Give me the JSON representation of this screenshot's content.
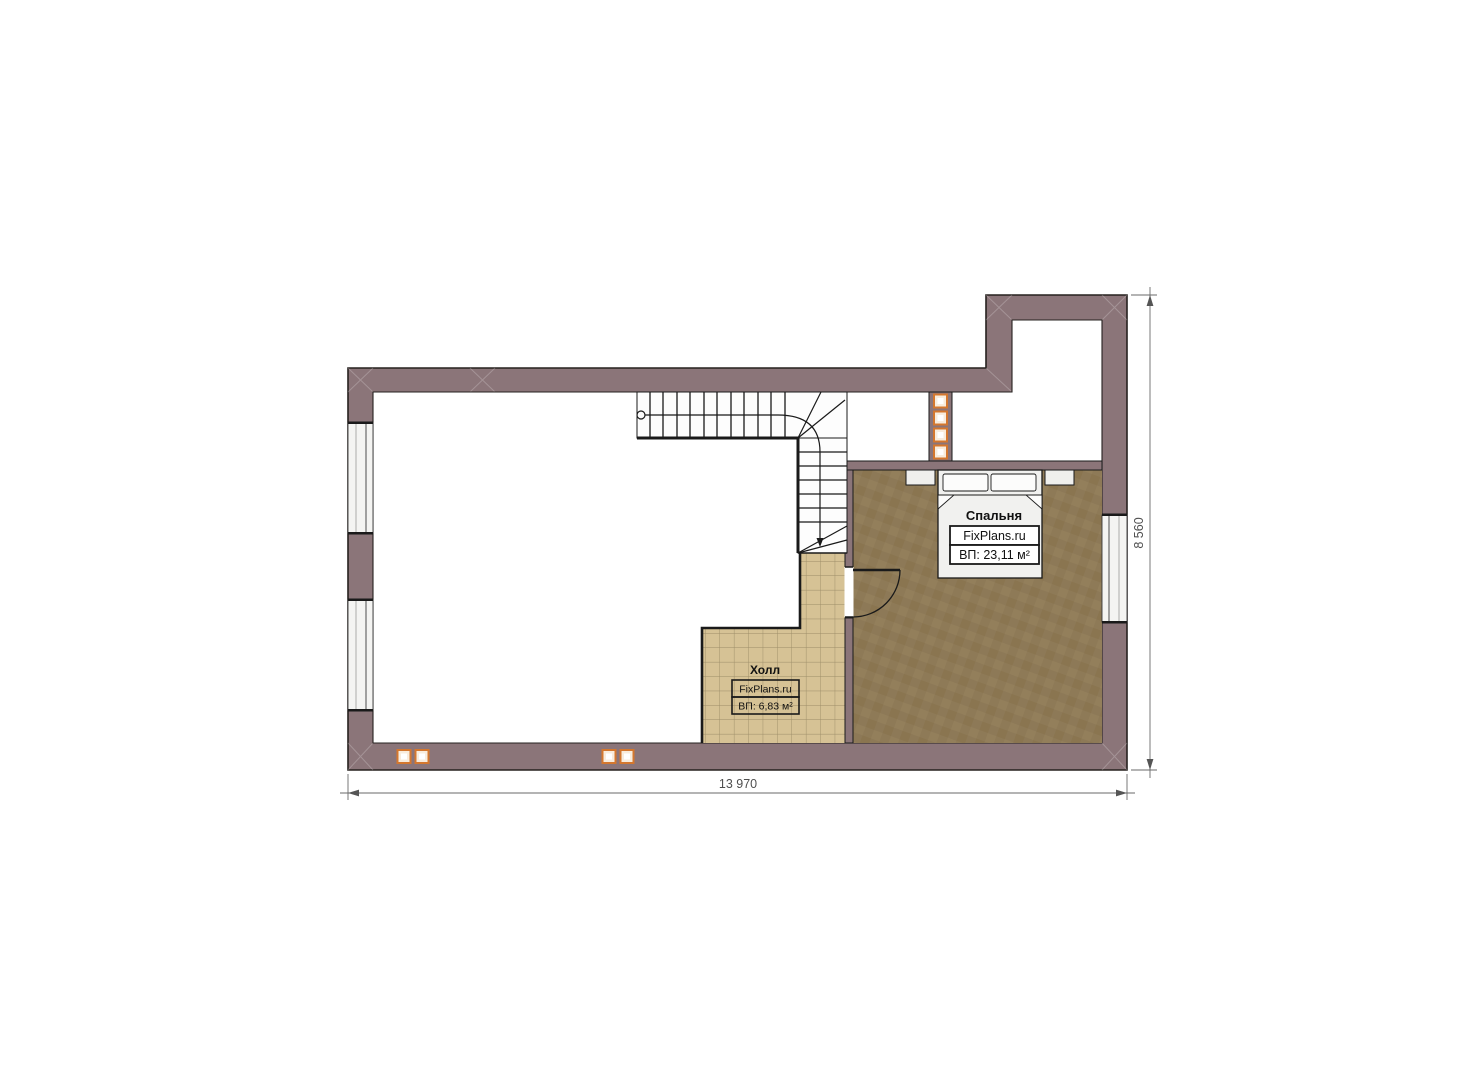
{
  "plan": {
    "rooms": {
      "bedroom": {
        "name": "Спальня",
        "site": "FixPlans.ru",
        "area": "ВП: 23,11 м²"
      },
      "hall": {
        "name": "Холл",
        "site": "FixPlans.ru",
        "area": "ВП: 6,83 м²"
      }
    },
    "dimensions": {
      "bottom": "13 970",
      "right": "8 560"
    },
    "colors": {
      "wall": "#8b7579",
      "wall_outline": "#26211f",
      "carpet": "#8e7a57",
      "tile": "#d6c295",
      "tile_grid": "#9c8c68",
      "vent_accent": "#d4772e",
      "line": "#1a1a1a",
      "dimension": "#5a5a5a"
    }
  }
}
